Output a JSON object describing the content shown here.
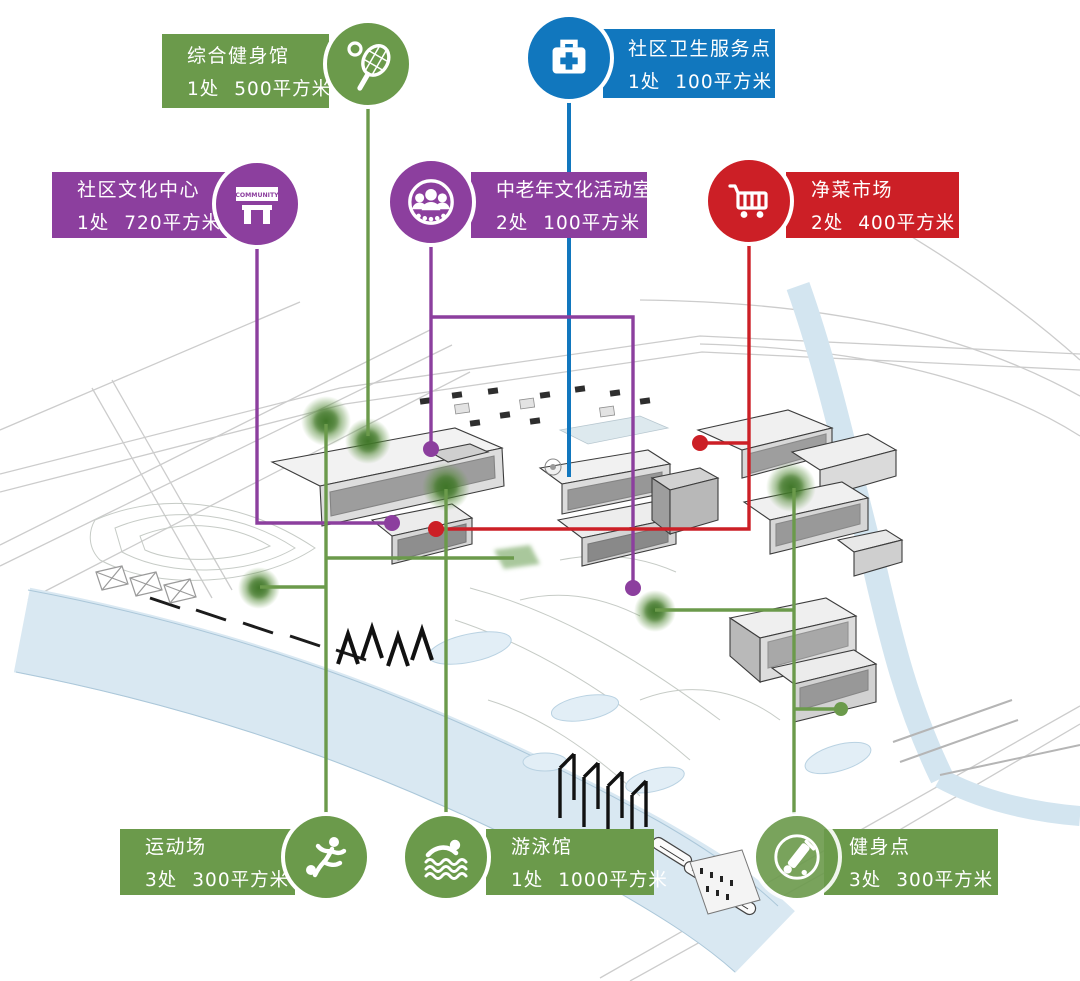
{
  "colors": {
    "green": "#6B9A4B",
    "blue": "#1177BE",
    "purple": "#8C3F9E",
    "red": "#CC1F26",
    "blob_core": "#3E7526",
    "water": "#D9E8F2"
  },
  "community_sign_text": "COMMUNITY",
  "callouts": [
    {
      "id": "fitness-gym",
      "title": "综合健身馆",
      "count": "1处",
      "area": "500平方米",
      "color": "green",
      "icon": "tennis-racket-icon"
    },
    {
      "id": "health-station",
      "title": "社区卫生服务点",
      "count": "1处",
      "area": "100平方米",
      "color": "blue",
      "icon": "first-aid-kit-icon"
    },
    {
      "id": "culture-center",
      "title": "社区文化中心",
      "count": "1处",
      "area": "720平方米",
      "color": "purple",
      "icon": "community-sign-icon"
    },
    {
      "id": "senior-activity-room",
      "title": "中老年文化活动室",
      "count": "2处",
      "area": "100平方米",
      "color": "purple",
      "icon": "people-group-icon"
    },
    {
      "id": "vegetable-market",
      "title": "净菜市场",
      "count": "2处",
      "area": "400平方米",
      "color": "red",
      "icon": "shopping-cart-icon"
    },
    {
      "id": "sports-field",
      "title": "运动场",
      "count": "3处",
      "area": "300平方米",
      "color": "green",
      "icon": "soccer-player-icon"
    },
    {
      "id": "swimming-pool",
      "title": "游泳馆",
      "count": "1处",
      "area": "1000平方米",
      "color": "green",
      "icon": "swimmer-icon"
    },
    {
      "id": "fitness-spot",
      "title": "健身点",
      "count": "3处",
      "area": "300平方米",
      "color": "green",
      "icon": "exercise-bike-icon"
    }
  ],
  "map": {
    "connectors": [
      {
        "id": "fitness-gym",
        "color": "green",
        "w": 3.4,
        "lines": [
          [
            [
              368,
              108
            ],
            [
              368,
              436
            ]
          ]
        ],
        "markers": [
          {
            "type": "blob",
            "x": 368,
            "y": 441,
            "r": 23
          }
        ]
      },
      {
        "id": "health-station",
        "color": "blue",
        "w": 4,
        "lines": [
          [
            [
              569,
              101
            ],
            [
              569,
              477
            ]
          ]
        ],
        "markers": []
      },
      {
        "id": "culture-center",
        "color": "purple",
        "w": 3.4,
        "lines": [
          [
            [
              257,
              248
            ],
            [
              257,
              523
            ],
            [
              390,
              523
            ]
          ]
        ],
        "markers": [
          {
            "type": "dot",
            "x": 392,
            "y": 523,
            "r": 8
          }
        ]
      },
      {
        "id": "senior-activity-room",
        "color": "purple",
        "w": 3.4,
        "lines": [
          [
            [
              431,
              245
            ],
            [
              431,
              449
            ]
          ],
          [
            [
              431,
              317
            ],
            [
              633,
              317
            ],
            [
              633,
              588
            ]
          ]
        ],
        "markers": [
          {
            "type": "dot",
            "x": 431,
            "y": 449,
            "r": 8
          },
          {
            "type": "dot",
            "x": 633,
            "y": 588,
            "r": 8
          }
        ]
      },
      {
        "id": "vegetable-market",
        "color": "red",
        "w": 3.4,
        "lines": [
          [
            [
              749,
              244
            ],
            [
              749,
              529
            ],
            [
              436,
              529
            ]
          ],
          [
            [
              700,
              443
            ],
            [
              749,
              443
            ]
          ]
        ],
        "markers": [
          {
            "type": "dot",
            "x": 700,
            "y": 443,
            "r": 8
          },
          {
            "type": "dot",
            "x": 436,
            "y": 529,
            "r": 8
          }
        ]
      },
      {
        "id": "sports-field",
        "color": "green",
        "w": 3.4,
        "lines": [
          [
            [
              326,
              814
            ],
            [
              326,
              424
            ]
          ],
          [
            [
              260,
              587
            ],
            [
              326,
              587
            ]
          ],
          [
            [
              326,
              558
            ],
            [
              514,
              558
            ]
          ]
        ],
        "markers": [
          {
            "type": "blob",
            "x": 326,
            "y": 421,
            "r": 25
          },
          {
            "type": "blob",
            "x": 259,
            "y": 588,
            "r": 21
          },
          {
            "type": "patch",
            "x": 516,
            "y": 557
          }
        ]
      },
      {
        "id": "swimming-pool",
        "color": "green",
        "w": 3.4,
        "lines": [
          [
            [
              446,
              813
            ],
            [
              446,
              489
            ]
          ]
        ],
        "markers": [
          {
            "type": "blob",
            "x": 446,
            "y": 487,
            "r": 24
          }
        ]
      },
      {
        "id": "fitness-spot",
        "color": "green",
        "w": 3.4,
        "lines": [
          [
            [
              794,
              814
            ],
            [
              794,
              488
            ]
          ],
          [
            [
              655,
              610
            ],
            [
              794,
              610
            ]
          ],
          [
            [
              794,
              709
            ],
            [
              840,
              709
            ]
          ]
        ],
        "markers": [
          {
            "type": "blob",
            "x": 791,
            "y": 487,
            "r": 25
          },
          {
            "type": "blob",
            "x": 655,
            "y": 611,
            "r": 21
          },
          {
            "type": "dot",
            "x": 841,
            "y": 709,
            "r": 7
          }
        ]
      }
    ]
  }
}
